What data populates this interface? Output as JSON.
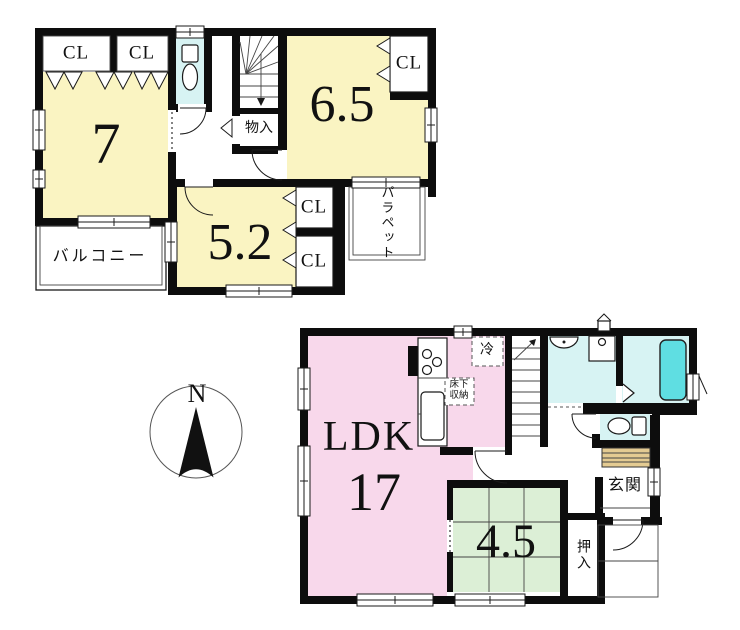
{
  "colors": {
    "wall": "#0d0d0d",
    "room_yellow": "#FAF4C2",
    "room_pink": "#F8D8EB",
    "room_green": "#DCEFD6",
    "wet_area_blue": "#D7F3F3",
    "bathtub_cyan": "#5FDEE2",
    "shoe_cabinet_tan": "#E4CB92"
  },
  "compass": {
    "north": "N"
  },
  "floor2": {
    "room7": "7",
    "room65": "6.5",
    "room52": "5.2",
    "closets": [
      "CL",
      "CL",
      "CL",
      "CL",
      "CL"
    ],
    "storage": "物入",
    "balcony": "バルコニー",
    "parapet": "パラペット"
  },
  "floor1": {
    "ldk_name": "LDK",
    "ldk_size": "17",
    "tatami_size": "4.5",
    "entrance": "玄関",
    "oshiire": "押入",
    "refrigerator": "冷",
    "floor_storage": "床下収納"
  }
}
